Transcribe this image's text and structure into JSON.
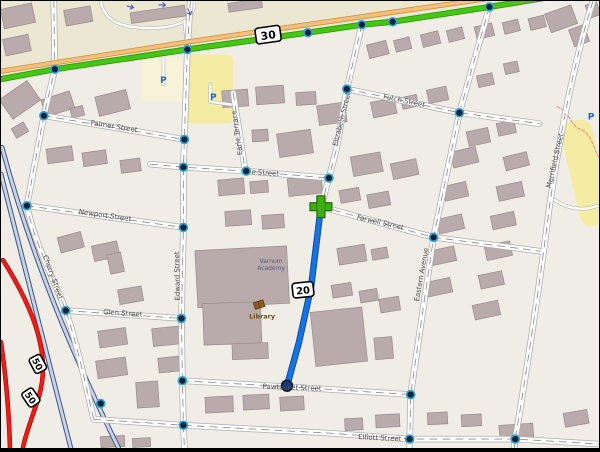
{
  "map": {
    "width": 600,
    "height": 452,
    "colors": {
      "bg": "#f0ede7",
      "land_upper": "#ece7d3",
      "building_fill": "#b9abab",
      "building_stroke": "#9a8b8b",
      "street_casing": "#adadad",
      "street_fill": "#ffffff",
      "street_dash": "#8f8f8f",
      "service_casing": "#b5b5b5",
      "trunk_green": "#46c614",
      "trunk_green_casing": "#2f9b06",
      "primary_tan": "#f4bf7a",
      "primary_tan_casing": "#c98f3e",
      "motorway_fill": "#cdd5e4",
      "motorway_casing": "#46608f",
      "red_road": "#ef1d18",
      "red_road_casing": "#b00c08",
      "route_blue": "#1673e0",
      "route_blue_casing": "#0a4faa",
      "route_start_green": "#3fae12",
      "route_start_outline": "#1e6a00",
      "route_end_fill": "#173a7e",
      "node_core": "#14202e",
      "node_ring": "#2aa6de",
      "parking_yellow": "#f4eca2",
      "parking_pale": "#f8f3d8",
      "parking_p_blue": "#1e66c8",
      "path_pink": "#f4918c",
      "label_gray": "#4e4e4e",
      "academy_label": "#4c5a7a",
      "library_brown": "#734a08",
      "oneway_arrow": "#4b54c8",
      "shield_bg": "#ffffff",
      "shield_border": "#000000"
    },
    "route_shields": [
      {
        "label": "30",
        "x": 268,
        "y": 34,
        "w": 25,
        "h": 16,
        "rot": -8,
        "font": 11
      },
      {
        "label": "20",
        "x": 303,
        "y": 292,
        "w": 21,
        "h": 15,
        "rot": -6,
        "font": 10
      },
      {
        "label": "50",
        "x": 37,
        "y": 367,
        "w": 17,
        "h": 13,
        "rot": 62,
        "font": 9
      },
      {
        "label": "50",
        "x": 30,
        "y": 401,
        "w": 17,
        "h": 13,
        "rot": 56,
        "font": 9
      }
    ],
    "street_labels": [
      {
        "text": "Palmer Street",
        "x": 113,
        "y": 129,
        "rot": 9
      },
      {
        "text": "e Street",
        "x": 265,
        "y": 176,
        "rot": 4
      },
      {
        "text": "Futch Street",
        "x": 404,
        "y": 103,
        "rot": 12
      },
      {
        "text": "Newport Street",
        "x": 104,
        "y": 219,
        "rot": 8
      },
      {
        "text": "Farwell Street",
        "x": 380,
        "y": 226,
        "rot": 13
      },
      {
        "text": "Glen Street",
        "x": 122,
        "y": 318,
        "rot": 4
      },
      {
        "text": "Pawtucket Street",
        "x": 292,
        "y": 393,
        "rot": 2
      },
      {
        "text": "Elliott Street",
        "x": 380,
        "y": 444,
        "rot": 3
      },
      {
        "text": "Cherry Street",
        "x": 50,
        "y": 280,
        "rot": 70
      },
      {
        "text": "Edward Street",
        "x": 179,
        "y": 278,
        "rot": -91
      },
      {
        "text": "Elizabeth Street",
        "x": 344,
        "y": 120,
        "rot": -76
      },
      {
        "text": "Eastern Avenue",
        "x": 424,
        "y": 277,
        "rot": -80
      },
      {
        "text": "Merrifield Street",
        "x": 558,
        "y": 162,
        "rot": -77
      },
      {
        "text": "Earle Terrace",
        "x": 239,
        "y": 133,
        "rot": -98
      }
    ],
    "poi_labels": [
      {
        "text": "Varnum",
        "x": 271,
        "y": 265,
        "color": "#4c5a7a",
        "size": 6,
        "bold": false
      },
      {
        "text": "Academy",
        "x": 271,
        "y": 272,
        "color": "#4c5a7a",
        "size": 6,
        "bold": false
      },
      {
        "text": "Library",
        "x": 262,
        "y": 321,
        "color": "#734a08",
        "size": 6.5,
        "bold": true
      }
    ],
    "parking_labels": [
      {
        "text": "P",
        "x": 163,
        "y": 83
      },
      {
        "text": "P",
        "x": 213,
        "y": 100
      },
      {
        "text": "P",
        "x": 592,
        "y": 120
      }
    ],
    "library_icon": {
      "x": 259,
      "y": 307
    },
    "oneway_arrows": [
      {
        "x": 130,
        "y": 6,
        "rot": 15
      },
      {
        "x": 162,
        "y": 4,
        "rot": 0
      },
      {
        "x": 189,
        "y": 11,
        "rot": 65
      }
    ],
    "areas": {
      "land_upper_poly": "0,0 545,0 490,9 308,35 187,52 54,72 0,82",
      "parking_lots": [
        {
          "x": 141,
          "y": 57,
          "w": 41,
          "h": 44,
          "rot": 0,
          "rx": 4,
          "pale": true
        },
        {
          "x": 183,
          "y": 54,
          "w": 50,
          "h": 70,
          "rot": 0,
          "rx": 6,
          "pale": false
        },
        {
          "x": 571,
          "y": 120,
          "w": 32,
          "h": 108,
          "rot": -13,
          "rx": 12,
          "pale": false
        }
      ],
      "pink_path": "M558,107 C572,112 570,126 582,130 C592,134 594,148 600,158"
    },
    "roads": {
      "trunk": {
        "name": "route-30-trunk",
        "d": "M0,79 L54,69 L187,49 L308,32 L362,24 L393,21 L490,6 L545,-3"
      },
      "primary": {
        "name": "primary-parallel",
        "d": "M0,71 L190,41 L540,-10"
      },
      "motorway_blue": [
        {
          "name": "motorway-a",
          "d": "M1,148 C28,250 68,350 118,452"
        },
        {
          "name": "motorway-b",
          "d": "M0,175 C22,265 45,355 70,452"
        }
      ],
      "motorway_red": [
        {
          "name": "highway-50-main",
          "d": "M2,262 C35,315 50,360 38,400 C30,425 24,440 22,452"
        },
        {
          "name": "highway-50-ramp",
          "d": "M0,345 C5,380 8,415 9,452"
        }
      ],
      "residential": [
        {
          "name": "cherry-street",
          "d": "M53,0 L54,69 L43,116 L26,207 C33,242 48,270 65,313 C76,346 86,392 93,423"
        },
        {
          "name": "edward-street",
          "d": "M190,0 L187,49 L184,140 L183,168 L183,229 L181,321 L182,384 L183,429 L184,452"
        },
        {
          "name": "earle-terrace",
          "d": "M233,93 L245,171"
        },
        {
          "name": "elizabeth-street",
          "d": "M362,24 L347,89 L337,148 L329,179 L321,208 L311,290 L299,345 L287,389"
        },
        {
          "name": "eastern-avenue",
          "d": "M490,6 L460,113 L434,239 L411,398 L410,452"
        },
        {
          "name": "merrifield-street",
          "d": "M594,0 C575,60 560,140 550,210 C540,290 528,370 516,443 L515,452"
        },
        {
          "name": "palmer-street",
          "d": "M43,116 L184,140"
        },
        {
          "name": "e-street",
          "d": "M150,165 L183,168 L246,172 L329,179"
        },
        {
          "name": "futch-street",
          "d": "M347,89 L460,113 L540,124"
        },
        {
          "name": "newport-street",
          "d": "M26,207 L183,229"
        },
        {
          "name": "farwell-street",
          "d": "M321,208 L434,239 L541,253"
        },
        {
          "name": "glen-street",
          "d": "M65,313 L181,321"
        },
        {
          "name": "pawtucket-street",
          "d": "M182,384 L287,390 L411,398"
        },
        {
          "name": "elliott-street",
          "d": "M93,423 L183,429 L330,437 L410,443 L516,443 L600,448"
        }
      ],
      "service": [
        {
          "name": "loop-road",
          "d": "M100,0 C102,14 112,23 130,26 C152,29 172,27 183,21 C191,16 194,8 194,0"
        },
        {
          "name": "loop-connector",
          "d": "M184,20 L187,49"
        },
        {
          "name": "parking-access-1",
          "d": "M163,56 L163,84"
        },
        {
          "name": "parking-access-2",
          "d": "M210,84 L210,102 L233,105"
        },
        {
          "name": "merrifield-access",
          "d": "M551,198 Q574,216 599,207"
        }
      ]
    },
    "route": {
      "line": "M321,208 L311,290 L299,345 L287,389",
      "start": {
        "x": 321,
        "y": 208
      },
      "end": {
        "x": 287,
        "y": 389
      }
    },
    "junction_nodes_xy": [
      [
        54,
        69
      ],
      [
        187,
        49
      ],
      [
        308,
        32
      ],
      [
        362,
        24
      ],
      [
        393,
        21
      ],
      [
        490,
        6
      ],
      [
        43,
        116
      ],
      [
        184,
        140
      ],
      [
        183,
        168
      ],
      [
        246,
        172
      ],
      [
        329,
        179
      ],
      [
        347,
        89
      ],
      [
        460,
        113
      ],
      [
        26,
        207
      ],
      [
        183,
        229
      ],
      [
        434,
        239
      ],
      [
        65,
        313
      ],
      [
        181,
        321
      ],
      [
        182,
        384
      ],
      [
        411,
        398
      ],
      [
        183,
        429
      ],
      [
        410,
        443
      ],
      [
        516,
        443
      ],
      [
        100,
        407
      ]
    ],
    "buildings_xywhr": [
      [
        1,
        5,
        32,
        20,
        -12
      ],
      [
        3,
        36,
        26,
        17,
        -12
      ],
      [
        64,
        7,
        27,
        16,
        -10
      ],
      [
        130,
        8,
        55,
        11,
        -8
      ],
      [
        228,
        0,
        34,
        9,
        -8
      ],
      [
        548,
        8,
        28,
        20,
        -20
      ],
      [
        572,
        26,
        16,
        18,
        -20
      ],
      [
        588,
        2,
        12,
        14,
        -20
      ],
      [
        2,
        88,
        34,
        24,
        -35
      ],
      [
        42,
        95,
        30,
        18,
        -18
      ],
      [
        96,
        93,
        32,
        20,
        -14
      ],
      [
        70,
        107,
        13,
        10,
        -14
      ],
      [
        12,
        125,
        14,
        11,
        -30
      ],
      [
        46,
        148,
        26,
        15,
        -8
      ],
      [
        82,
        152,
        24,
        14,
        -8
      ],
      [
        120,
        160,
        20,
        13,
        -8
      ],
      [
        222,
        90,
        26,
        17,
        -4
      ],
      [
        256,
        86,
        28,
        18,
        -4
      ],
      [
        296,
        92,
        20,
        13,
        -4
      ],
      [
        318,
        104,
        28,
        20,
        -8
      ],
      [
        252,
        130,
        16,
        12,
        -4
      ],
      [
        278,
        132,
        34,
        24,
        -8
      ],
      [
        368,
        42,
        20,
        14,
        -14
      ],
      [
        395,
        38,
        16,
        12,
        -14
      ],
      [
        422,
        32,
        18,
        13,
        -14
      ],
      [
        448,
        28,
        16,
        12,
        -14
      ],
      [
        476,
        24,
        18,
        13,
        -14
      ],
      [
        504,
        20,
        16,
        12,
        -14
      ],
      [
        530,
        16,
        16,
        12,
        -14
      ],
      [
        372,
        100,
        24,
        16,
        -12
      ],
      [
        402,
        96,
        16,
        12,
        -12
      ],
      [
        428,
        88,
        20,
        14,
        -12
      ],
      [
        478,
        74,
        16,
        12,
        -12
      ],
      [
        505,
        62,
        14,
        11,
        -12
      ],
      [
        468,
        130,
        22,
        15,
        -12
      ],
      [
        498,
        122,
        18,
        13,
        -12
      ],
      [
        505,
        155,
        24,
        14,
        -14
      ],
      [
        498,
        185,
        26,
        15,
        -12
      ],
      [
        492,
        215,
        24,
        14,
        -12
      ],
      [
        486,
        245,
        26,
        15,
        -12
      ],
      [
        480,
        275,
        24,
        14,
        -12
      ],
      [
        474,
        305,
        26,
        15,
        -12
      ],
      [
        452,
        150,
        26,
        16,
        -14
      ],
      [
        444,
        185,
        24,
        15,
        -13
      ],
      [
        438,
        218,
        26,
        15,
        -13
      ],
      [
        432,
        250,
        24,
        15,
        -12
      ],
      [
        426,
        282,
        26,
        15,
        -12
      ],
      [
        352,
        155,
        30,
        20,
        -10
      ],
      [
        392,
        162,
        26,
        16,
        -12
      ],
      [
        340,
        190,
        20,
        13,
        -10
      ],
      [
        368,
        194,
        22,
        14,
        -10
      ],
      [
        288,
        178,
        34,
        18,
        -6
      ],
      [
        218,
        180,
        26,
        16,
        -5
      ],
      [
        250,
        182,
        18,
        12,
        -5
      ],
      [
        225,
        212,
        26,
        15,
        -4
      ],
      [
        262,
        216,
        22,
        14,
        -4
      ],
      [
        338,
        248,
        28,
        17,
        -9
      ],
      [
        332,
        286,
        20,
        13,
        -9
      ],
      [
        360,
        292,
        18,
        12,
        -9
      ],
      [
        372,
        250,
        16,
        11,
        -10
      ],
      [
        380,
        300,
        20,
        14,
        -9
      ],
      [
        375,
        340,
        18,
        22,
        -5
      ],
      [
        313,
        312,
        52,
        55,
        -6
      ],
      [
        196,
        250,
        92,
        58,
        -3
      ],
      [
        203,
        305,
        58,
        42,
        -2
      ],
      [
        232,
        346,
        36,
        16,
        -2
      ],
      [
        58,
        236,
        24,
        16,
        -15
      ],
      [
        92,
        245,
        26,
        16,
        -12
      ],
      [
        118,
        290,
        24,
        15,
        -10
      ],
      [
        108,
        255,
        14,
        20,
        -12
      ],
      [
        98,
        332,
        28,
        17,
        -8
      ],
      [
        96,
        362,
        30,
        18,
        -8
      ],
      [
        136,
        385,
        22,
        26,
        -4
      ],
      [
        152,
        330,
        28,
        18,
        -6
      ],
      [
        158,
        360,
        24,
        15,
        -6
      ],
      [
        100,
        440,
        24,
        11,
        -3
      ],
      [
        132,
        442,
        18,
        9,
        -3
      ],
      [
        205,
        400,
        28,
        16,
        -3
      ],
      [
        243,
        398,
        26,
        15,
        -3
      ],
      [
        280,
        400,
        24,
        14,
        -3
      ],
      [
        345,
        422,
        18,
        12,
        -3
      ],
      [
        376,
        418,
        24,
        13,
        -3
      ],
      [
        428,
        416,
        20,
        12,
        -3
      ],
      [
        462,
        418,
        20,
        12,
        -3
      ],
      [
        500,
        428,
        34,
        14,
        -4
      ],
      [
        565,
        415,
        24,
        14,
        -10
      ]
    ]
  }
}
